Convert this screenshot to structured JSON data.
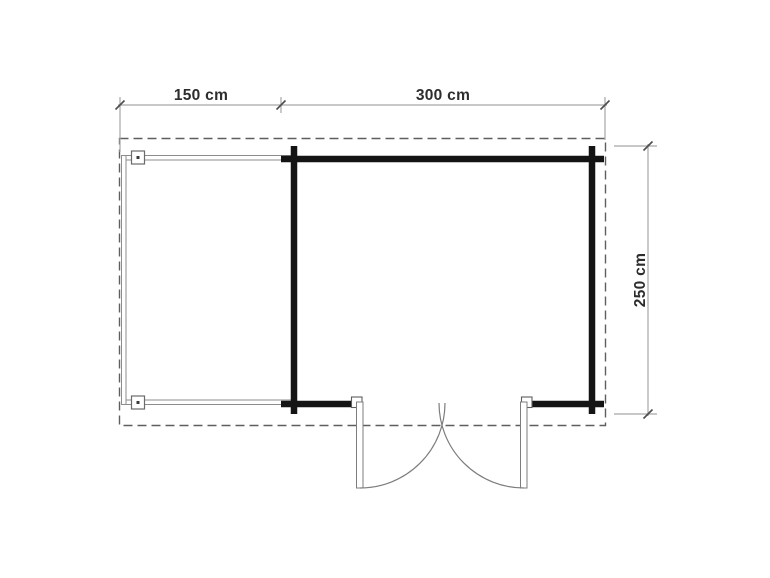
{
  "figure": {
    "type": "floor-plan",
    "labels": {
      "terrace_width": "150 cm",
      "cabin_width": "300 cm",
      "depth": "250 cm"
    }
  },
  "colors": {
    "background": "#ffffff",
    "wall": "#141414",
    "thin_line": "#8c8c8c",
    "dashed_outline": "#5f5f5f",
    "dimension_line": "#a6a6a6",
    "dimension_tick": "#4d4d4d",
    "label_text": "#2d2d2d"
  }
}
